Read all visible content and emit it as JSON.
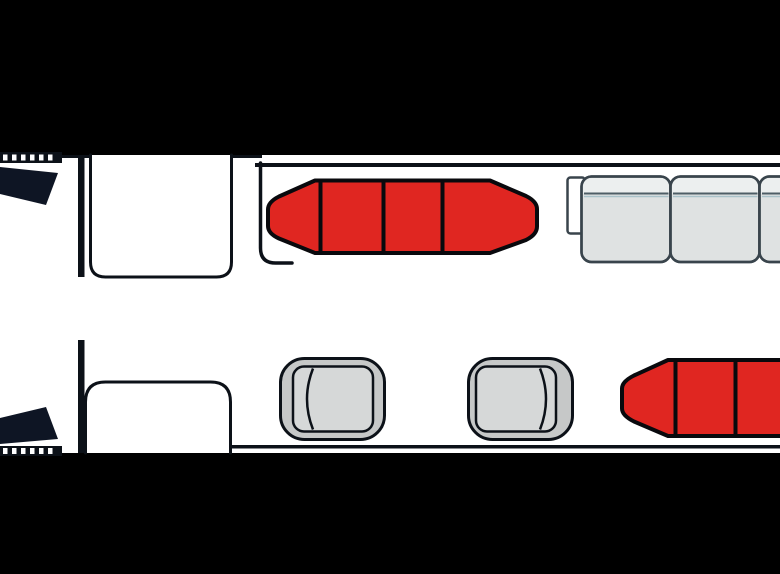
{
  "diagram": {
    "type": "aircraft-cabin-floor-plan",
    "view": "top-down",
    "cockpit": {
      "windshield_panels": 2,
      "window_ticks_per_side": 6,
      "bulkheads": 2,
      "closets": 2
    },
    "port_side_items": [
      {
        "item": "red-divan-forward",
        "sections": 4,
        "divider_lines": 3,
        "color_key": "divan_red"
      },
      {
        "item": "gray-sofa-aft",
        "cushions_visible": 3,
        "armrest": true,
        "cut_off_right": true,
        "color_key": "sofa_cushion"
      }
    ],
    "starboard_side_items": [
      {
        "item": "club-seat-forward",
        "backrest_side": "left"
      },
      {
        "item": "club-seat-mid",
        "backrest_side": "right"
      },
      {
        "item": "red-divan-aft",
        "sections_visible": 3,
        "divider_lines": 2,
        "cut_off_right": true,
        "color_key": "divan_red"
      }
    ]
  },
  "colors": {
    "background": "#000000",
    "cabin": "#ffffff",
    "outline": "#0c1118",
    "windshield": "#0e1524",
    "divan_red": "#e02621",
    "divan_outline": "#09090d",
    "seat_outer": "#c6c8c8",
    "seat_cushion": "#d6d8d8",
    "sofa_cushion": "#dfe2e2",
    "sofa_back": "#ecefef",
    "sofa_outline": "#39444c",
    "sofa_seam": "#4e5e66",
    "sofa_seam_light": "#a9c2c9"
  }
}
